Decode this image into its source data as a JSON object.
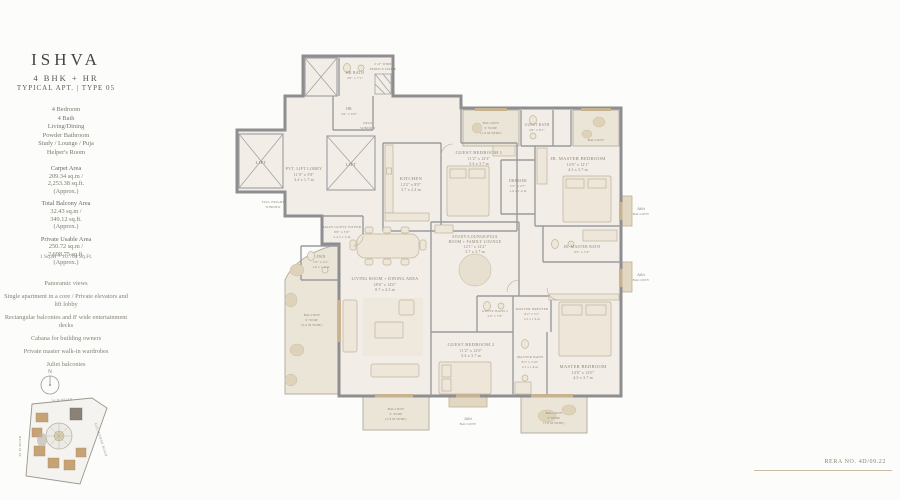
{
  "colors": {
    "wall": "#8e8e90",
    "floor": "#f2eee7",
    "balcony_floor": "#ebe5d8",
    "accent_tan": "#c7b391",
    "label": "#8d8376"
  },
  "sidebar": {
    "title": "ISHVA",
    "subtitle": "4 BHK + HR",
    "type_line": "TYPICAL APT. | TYPE 05",
    "config": [
      "4 Bedroom",
      "4 Bath",
      "Living/Dining",
      "Powder Bathroom",
      "Study / Lounge / Puja",
      "Helper's Room"
    ],
    "areas": [
      {
        "label": "Carpet Area",
        "sqm": "209.34 sq.m /",
        "sqft": "2,253.38 sq.ft.",
        "approx": "(Approx.)"
      },
      {
        "label": "Total Balcony Area",
        "sqm": "32.43 sq.m /",
        "sqft": "349.12 sq.ft.",
        "approx": "(Approx.)"
      },
      {
        "label": "Private Usable Area",
        "sqm": "250.72 sq.m /",
        "sqft": "2,698.75 sq.ft.",
        "approx": "(Approx.)"
      }
    ],
    "conversion": "1 Sq.M = 10.764 Sq.Ft.",
    "features": [
      "Panoramic views",
      "Single apartment in a core / Private elevators and lift lobby",
      "Rectangular balconies and 8' wide entertainment decks",
      "Cabana for building owners",
      "Private master walk-in wardrobes",
      "Juliet balconies"
    ],
    "compass": "N"
  },
  "site": {
    "road_top": "24 M ROAD",
    "road_left": "30 M ROAD",
    "road_right": "GULMOHAR ROAD"
  },
  "footer": {
    "text": "RERA NO. 4D/09.22"
  },
  "plan": {
    "rooms": {
      "lift": {
        "name": "LIFT"
      },
      "lobby": {
        "name": "PVT. LIFT LOBBY",
        "d1": "11'0\" x 5'8\"",
        "d2": "3.4 x 1.7 m"
      },
      "full_height_window": {
        "l1": "FULL HEIGHT",
        "l2": "WINDOW"
      },
      "deck_window": {
        "l1": "DECK",
        "l2": "WINDOW"
      },
      "hr_bath": {
        "name": "HR BATH",
        "d1": "4'0\" x 7'1\""
      },
      "hr": {
        "name": "HR",
        "d1": "5'6\" x 6'0\""
      },
      "service_ledge": {
        "l1": "2'-0\" WIDE",
        "l2": "SERVICE LEDGE"
      },
      "kitchen": {
        "name": "KITCHEN",
        "d1": "12'2\" x 8'0\"",
        "d2": "3.7 x 2.4 m"
      },
      "guest_bedroom_1": {
        "name": "GUEST BEDROOM 1",
        "d1": "11'2\" x 12'3\"",
        "d2": "3.4 x 3.7 m"
      },
      "guest_bath": {
        "name": "GUEST BATH",
        "d1": "4'6\" x 8'1\""
      },
      "balcony_6": {
        "l1": "BALCONY",
        "l2": "6' WIDE",
        "l3": "(1.8 M WIDE)"
      },
      "jr_master_bedroom": {
        "name": "JR. MASTER BEDROOM",
        "d1": "14'0\" x 12'1\"",
        "d2": "4.3 x 3.7 m"
      },
      "dresser": {
        "name": "DRESSER",
        "d1": "5'2\" x 4'7\"",
        "d2": "1.6 x 1.4 m"
      },
      "jr_master_bath": {
        "name": "JR. MASTER BATH",
        "d1": "8'2\" x 5'4\"",
        "d2": "2.5 x 1.6 m"
      },
      "juliet_balcony": {
        "l1": "Juliet",
        "l2": "BALCONY"
      },
      "study": {
        "l1": "STUDY/LOUNGE/PUJA",
        "l2": "ROOM + FAMILY LOUNGE",
        "d1": "12'1\" x 12'2\"",
        "d2": "3.7 x 3.7 m"
      },
      "main_guest_foyer": {
        "name": "MAIN GUEST FOYER",
        "d1": "8'0\" x 5'0\"",
        "d2": "2.4 x 1.5 m"
      },
      "pwd": {
        "name": "PWD",
        "d1": "5'2\" x 4'1\"",
        "d2": "1.6 x 1.2 m"
      },
      "living_dining": {
        "name": "LIVING ROOM + DINING AREA",
        "d1": "28'6\" x 14'0\"",
        "d2": "8.7 x 4.3 m"
      },
      "balcony_9": {
        "l1": "BALCONY",
        "l2": "9' WIDE",
        "l3": "(2.6 M WIDE)"
      },
      "guest_bedroom_2": {
        "name": "GUEST BEDROOM 2",
        "d1": "11'2\" x 12'0\"",
        "d2": "3.4 x 3.7 m"
      },
      "guest_bath_2": {
        "name": "GUEST BATH 2",
        "d1": "5'0\" x 7'8\""
      },
      "master_dresser": {
        "name": "MASTER DRESSER",
        "d1": "8'2\" x 5'2\"",
        "d2": "2.5 x 1.6 m"
      },
      "master_bath": {
        "name": "MASTER BATH",
        "d1": "8'2\" x 5'10\"",
        "d2": "2.5 x 1.8 m"
      },
      "master_bedroom": {
        "name": "MASTER BEDROOM",
        "d1": "14'0\" x 12'0\"",
        "d2": "4.3 x 3.7 m"
      }
    }
  }
}
